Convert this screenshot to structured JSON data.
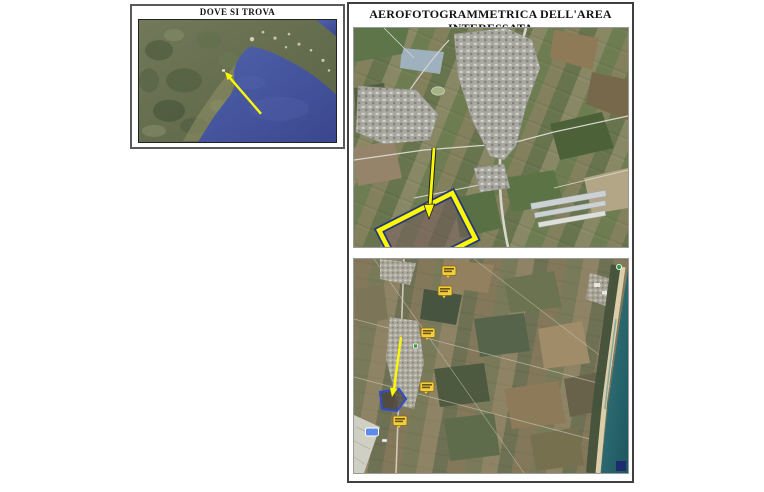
{
  "colors": {
    "accent_yellow": "#fcf803",
    "arrow_outline": "#1f1f1f",
    "highlight_edge_blue": "#27357c",
    "gulf_sea_blue": "#46549d",
    "coastal_sea_teal": "#2c6b72",
    "label_yellow": "#f2cd3e",
    "site_outline_blue": "#3350c0",
    "road_badge_blue": "#5c8bea",
    "marker_green": "#2f9e44",
    "panel_border_gray": "#4c4c4c"
  },
  "locator_panel": {
    "title": "DOVE SI TROVA"
  },
  "aero_panel": {
    "title": "AEROFOTOGRAMMETRICA DELL'AREA INTERESSATA"
  }
}
